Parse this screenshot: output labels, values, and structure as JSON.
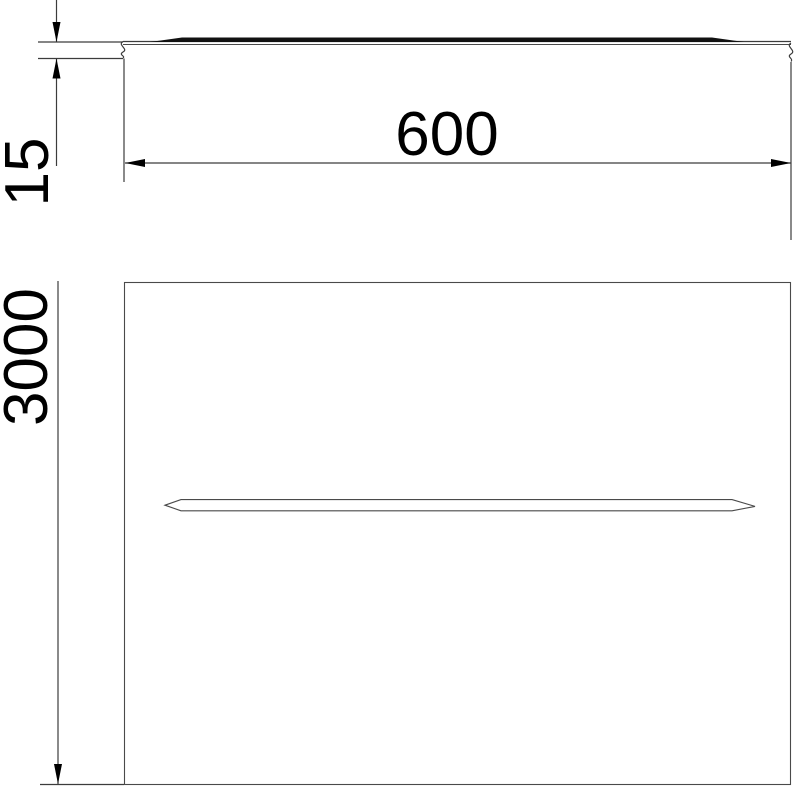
{
  "drawing": {
    "kind": "technical-dimension-drawing",
    "views": {
      "side_view": "cover profile (side view)",
      "top_view": "cover plate with stiffening rib (plan view)"
    }
  },
  "dimensions": {
    "profile_height": {
      "label": "15"
    },
    "width": {
      "label": "600"
    },
    "length": {
      "label": "3000"
    }
  },
  "colors": {
    "line_color": "#3c3c3c",
    "edge_color": "#4a4a4a",
    "text_color": "#000000",
    "fill_color": "#111111",
    "background": "#ffffff"
  }
}
